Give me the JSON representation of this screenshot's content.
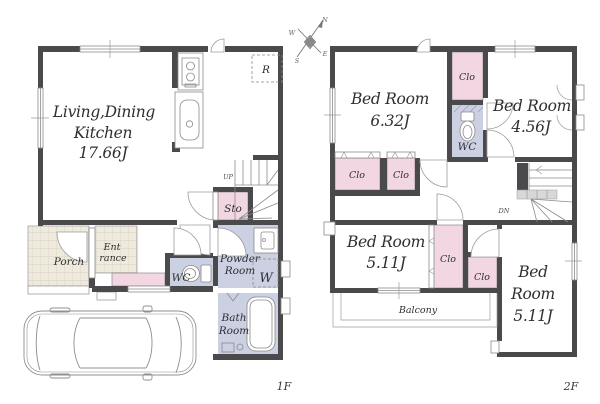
{
  "document": {
    "type": "house-floor-plan"
  },
  "colors": {
    "wall": "#4a494b",
    "closet_pink": "#f2d7e3",
    "wet_area_lavender": "#cbd0e2",
    "tile_beige": "#efeade",
    "outline_gray": "#8a8a8c",
    "text": "#2f2f31"
  },
  "floor1": {
    "floor_label": "1F",
    "ldk_label_1": "Living,Dining",
    "ldk_label_2": "Kitchen",
    "ldk_area": "17.66J",
    "refrigerator_label": "R",
    "stairs_label": "UP",
    "storage_label": "Sto",
    "porch_label": "Porch",
    "entrance_label_1": "Ent",
    "entrance_label_2": "rance",
    "wc_label": "WC",
    "powder_label_1": "Powder",
    "powder_label_2": "Room",
    "washer_label": "W",
    "bath_label_1": "Bath",
    "bath_label_2": "Room"
  },
  "floor2": {
    "floor_label": "2F",
    "bedroom1_label": "Bed Room",
    "bedroom1_area": "6.32J",
    "bedroom2_label": "Bed Room",
    "bedroom2_area": "4.56J",
    "bedroom3_label": "Bed Room",
    "bedroom3_area": "5.11J",
    "bedroom4_label_1": "Bed",
    "bedroom4_label_2": "Room",
    "bedroom4_area": "5.11J",
    "closet_top_label": "Clo",
    "closet_left_a_label": "Clo",
    "closet_left_b_label": "Clo",
    "closet_mid_label": "Clo",
    "closet_small_label": "Clo",
    "wc_label": "WC",
    "stairs_label": "DN",
    "balcony_label": "Balcony"
  },
  "compass": {
    "north": "N",
    "south": "S",
    "east": "E",
    "west": "W"
  }
}
